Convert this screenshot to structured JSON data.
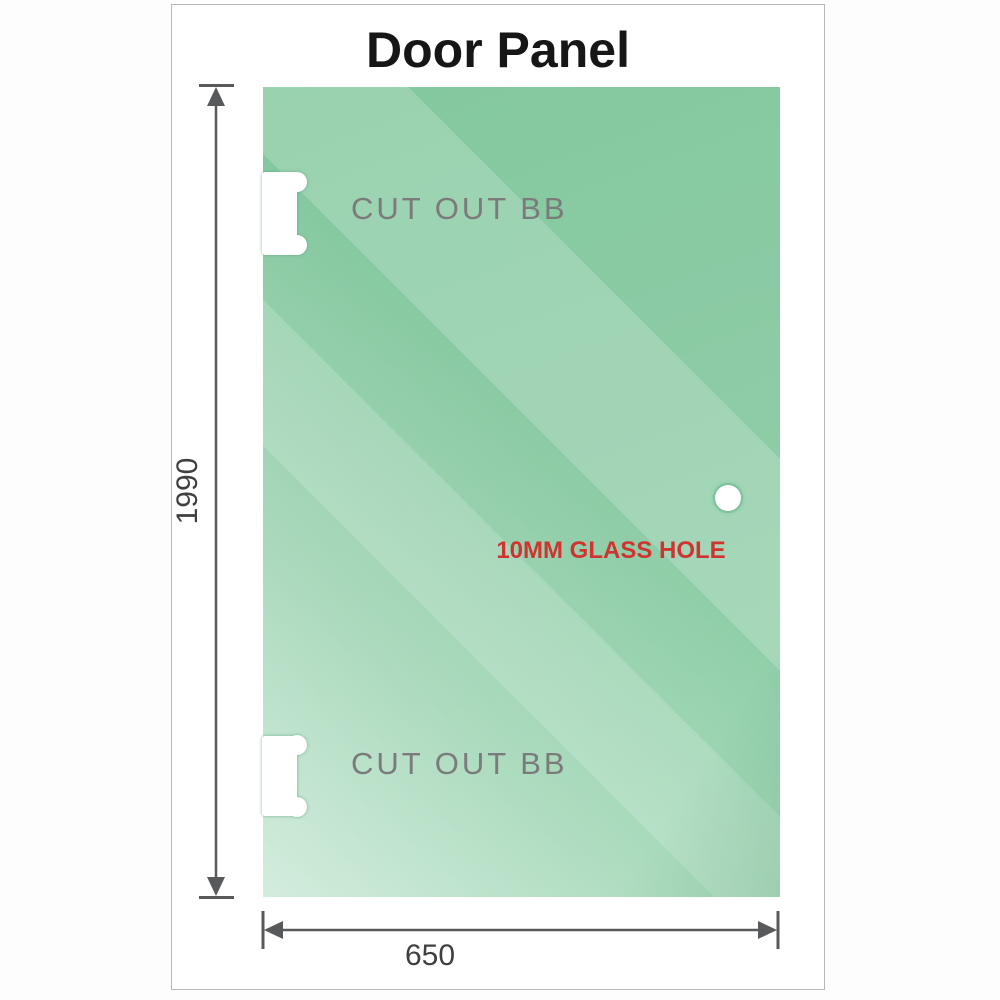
{
  "title": "Door Panel",
  "panel": {
    "cutout_label": "CUT OUT BB",
    "hole_label": "10MM GLASS HOLE",
    "glass_color": "#8ccba5",
    "glass_highlight": "#cdebd9",
    "hole_label_color": "#cf3430",
    "cutout_label_color": "#7b7b7b"
  },
  "dimensions": {
    "height_label": "1990",
    "width_label": "650",
    "line_color": "#58595b"
  }
}
